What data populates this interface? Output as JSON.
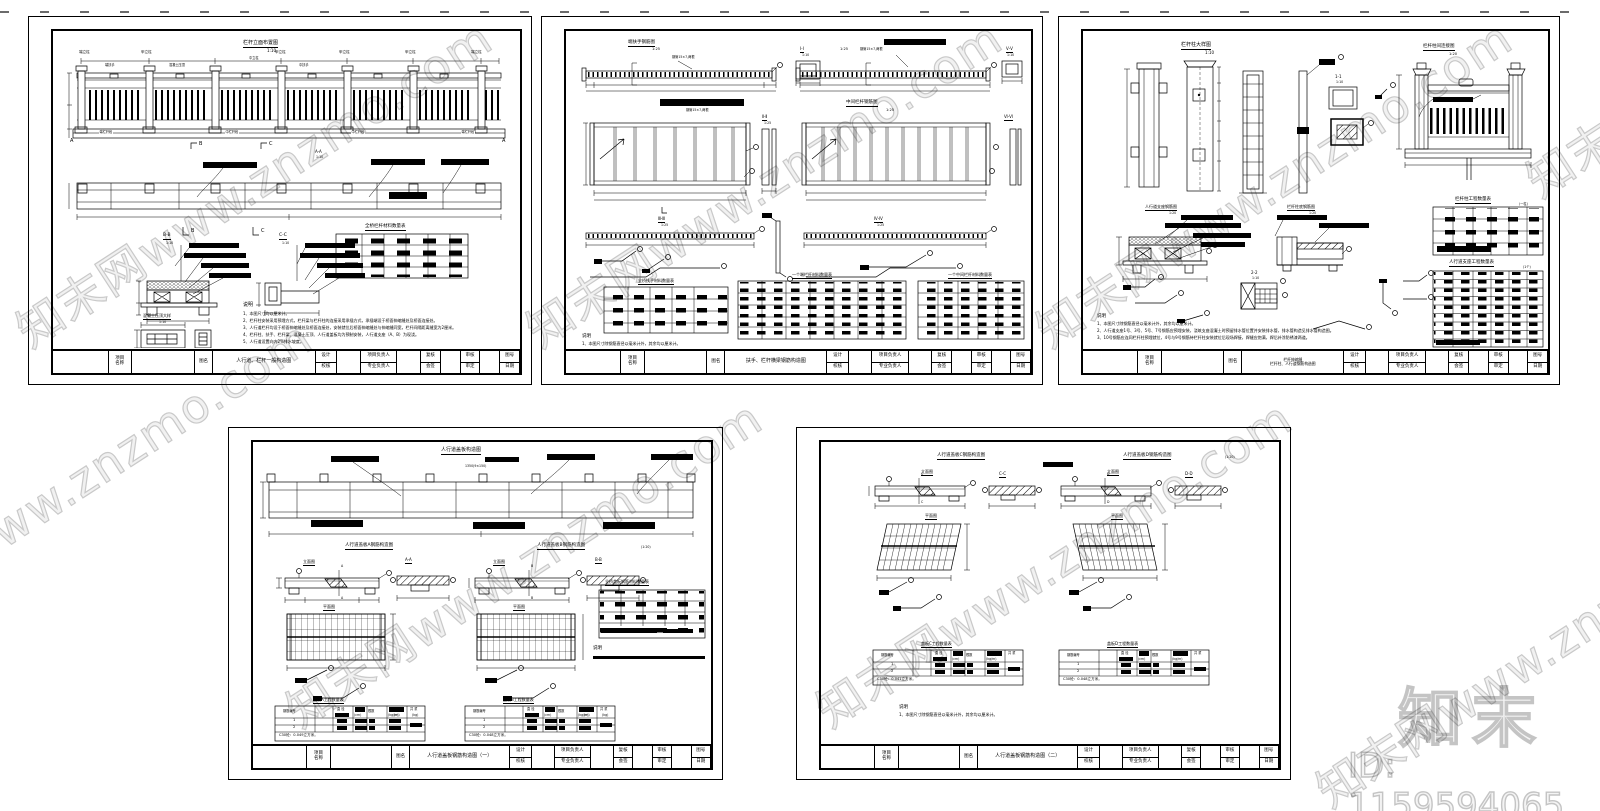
{
  "wm": {
    "text": "知末网www.znzmo.com",
    "logo": "知末",
    "id": "ID: 1159594065"
  },
  "tb": {
    "project1": "项目",
    "project2": "名称",
    "name": "图名",
    "design": "设计",
    "check": "校核",
    "pm": "项目负责人",
    "lead": "专业负责人",
    "review": "复核",
    "sign": "会签",
    "audit": "审核",
    "approve": "审定",
    "no": "图号",
    "date": "日期"
  },
  "s1": {
    "title": "栏杆立面布置图",
    "scale": "1:10",
    "lbl_end_post": "端立柱",
    "lbl_a_post": "甲立柱",
    "lbl_mid_post": "中立柱",
    "lbl_end_rail": "端扶手",
    "lbl_mid_rail": "中扶手",
    "lbl_cap": "混凝土压顶",
    "lbl_seg_end": "端栏杆段",
    "lbl_seg_mid": "中栏杆段",
    "mark_a": "A",
    "mark_b": "B",
    "mark_c": "C",
    "sec_aa": "A-A",
    "sec_bb": "B-B",
    "sec_cc": "C-C",
    "scale_small": "1:10",
    "cap_detail": "混凝土压顶大样",
    "table_title": "全桥栏杆材料数量表",
    "notes_title": "说明",
    "notes": [
      "1、本图尺寸均以厘米计。",
      "2、栏杆柱安装采用预埋方式，栏杆梁与栏杆柱的连接采用承插方式，承插端设于桥面伸缩缝处及桥面连接处。",
      "3、人行道栏杆均设于桥面伸缩缝处及桥面连接处，安装就位后桥面伸缩缝处与伸缩缝同宽，栏杆间隔距离缝宽为2厘米。",
      "4、栏杆柱、扶手、栏杆梁、混凝土压顶、人行道盖板均为预制安装，人行道支座（A、B）为现浇。",
      "5、人行道设置向内2%排水坡度。"
    ],
    "tb_title": "人行道、栏杆一般构造图"
  },
  "s2": {
    "t1": "端扶手钢筋图",
    "t1s": "1:25",
    "t1sub": "钢管15×7,两根",
    "t4": "中间栏杆钢筋图",
    "t4s": "1:25",
    "sec1": "Ⅰ-Ⅰ",
    "sec1s": "1:10",
    "sec2": "Ⅴ-Ⅴ",
    "sec2s": "1:10",
    "sec3": "Ⅱ-Ⅱ",
    "sec3s": "1:25",
    "sec4": "Ⅵ-Ⅵ",
    "sec4s": "1:25",
    "sec5": "Ⅲ-Ⅲ",
    "sec5s": "1:25",
    "sec6": "Ⅳ-Ⅳ",
    "sec6s": "1:25",
    "tbl1": "全桥扶手材料数量表",
    "tbl2": "一个端栏杆材料数量表",
    "tbl3": "一个中间栏杆材料数量表",
    "notes_title": "说明",
    "n1": "1、本图尺寸除钢筋直径以毫米计外，其余均以厘米计。",
    "tb_title": "扶手、栏杆横梁钢筋构造图"
  },
  "s3": {
    "t1": "栏杆柱大样图",
    "t1s": "1:10",
    "t2": "栏杆柱间连接图",
    "t2s": "1:20",
    "sec1": "1-1",
    "sec1s": "1:10",
    "sec2": "2-2",
    "sec2s": "1:10",
    "d1": "人行道支座钢筋图",
    "d1s": "1:20",
    "d2": "栏杆柱底钢筋图",
    "d2s": "1:20",
    "tbl1": "栏杆柱工程数量表",
    "tbl1sub": "(一柱)",
    "tbl2": "人行道支座工程数量表",
    "tbl2sub": "(1个)",
    "notes_title": "说明",
    "notes": [
      "1、本图尺寸除钢筋直径以毫米计外，其余均以厘米计。",
      "2、人行道支座1号、3号、5号、7号钢筋应预埋安装，浇筑支座混凝土时预留排水管位置并安装排水管，排水管构造见排水管构造图。",
      "3、10号钢筋应连同栏杆柱预埋就位，4号与9号钢筋待栏杆柱安装就位后现场焊接，焊缝应饱满，焊后补涂防锈漆两道。"
    ],
    "tb_title1": "栏杆伸缩缝",
    "tb_title2": "栏杆柱、人行道钢筋构造图"
  },
  "s4": {
    "strip_title": "人行道盖板构造图",
    "strip_dim": "1350(9×150)",
    "gA": "人行道盖板A钢筋构造图",
    "gB": "人行道盖板B钢筋构造图",
    "gs": "(1:20)",
    "elev": "立面图",
    "plan": "平面图",
    "secA": "A-A",
    "secB": "B-B",
    "mA": "A",
    "mB": "B",
    "tblA": "盖板A工程数量表",
    "tblB": "盖板B工程数量表",
    "r1": "1",
    "r2": "2",
    "ftA": "C30砼：0.049立方米。",
    "ftB": "C30砼：0.048立方米。",
    "rtbl": "全桥盖板钢筋材料数量表",
    "notes_title": "说明",
    "tb_title": "人行道盖板钢筋构造图（一）"
  },
  "s5": {
    "gC": "人行道盖板C钢筋构造图",
    "gD": "人行道盖板D钢筋构造图",
    "gs": "(1:20)",
    "elev": "立面图",
    "plan": "平面图",
    "secC": "C-C",
    "secD": "D-D",
    "mC": "C",
    "mD": "D",
    "tblC": "盖板C工程数量表",
    "tblD": "盖板D工程数量表",
    "r1": "1",
    "r2": "2",
    "ftC": "C30砼：0.041立方米。",
    "ftD": "C30砼：0.048立方米。",
    "notes_title": "说明",
    "n1": "1、本图尺寸除钢筋直径以毫米计外，其余均以厘米计。",
    "tb_title": "人行道盖板钢筋构造图（二）"
  },
  "qt": {
    "h_no": "钢筋编号",
    "h_dia": "直 径",
    "h_len": "(cm)",
    "h_cnt": "根数",
    "h_uw": "(kg/m)",
    "h_tl": "共 长",
    "h_tlu": "(m)",
    "h_tw": "共 重",
    "h_twu": "(kg)"
  }
}
